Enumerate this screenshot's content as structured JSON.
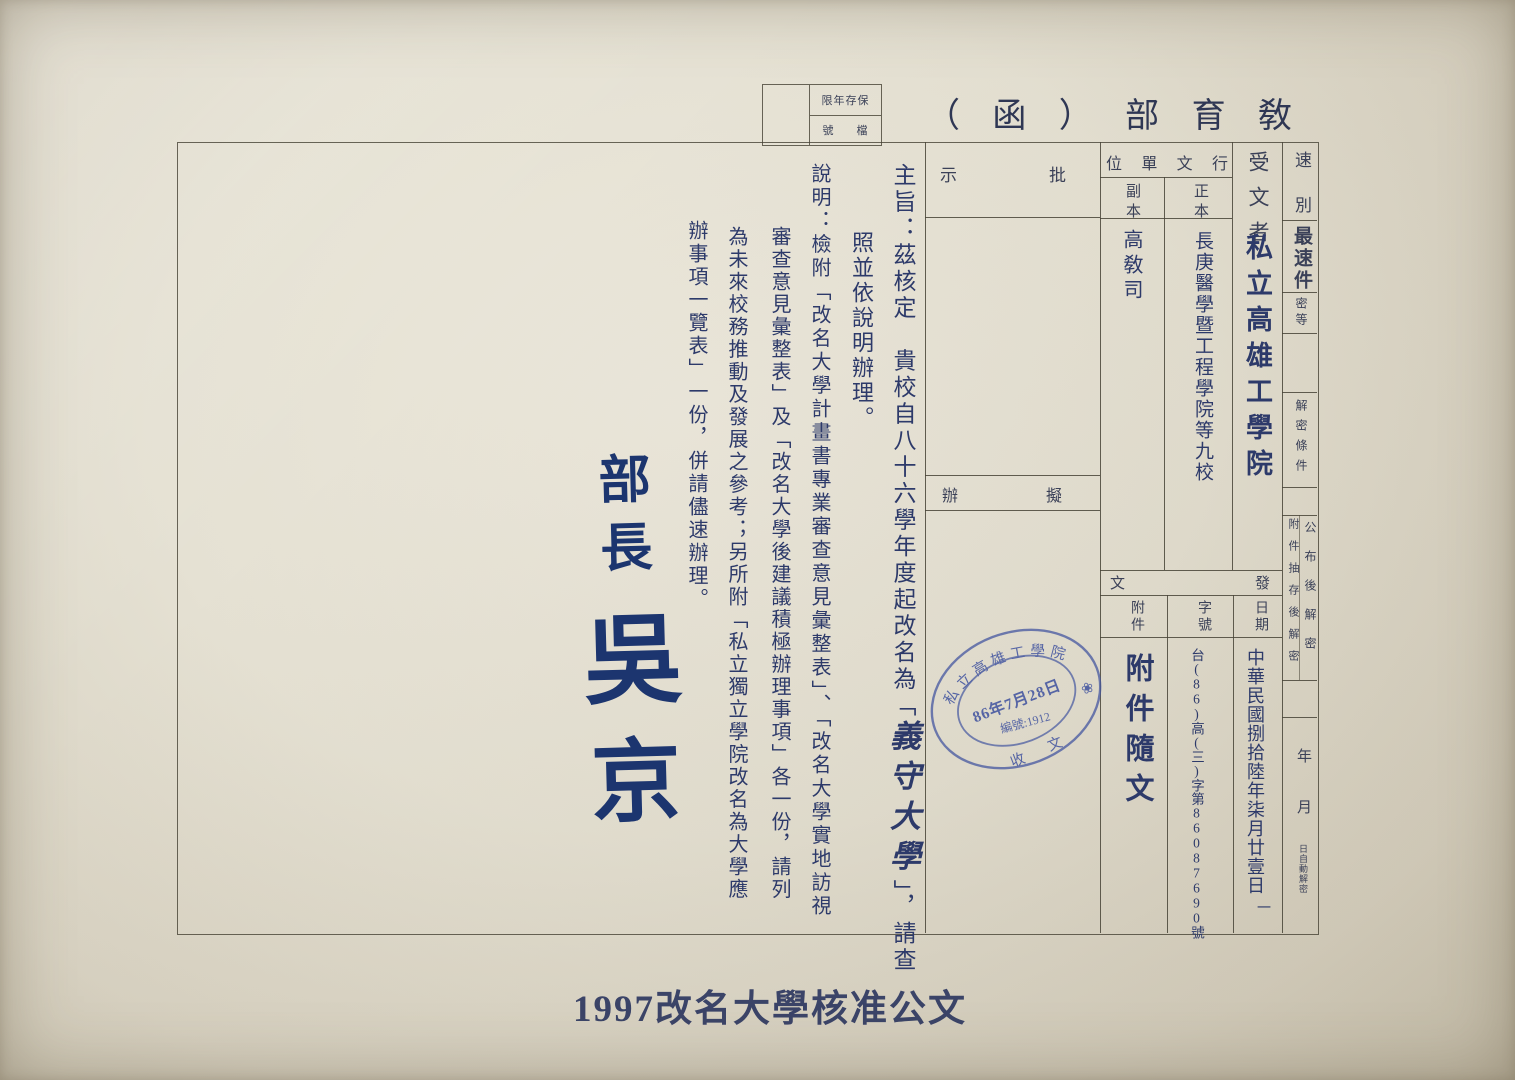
{
  "colors": {
    "paper": "#e7e3d6",
    "ink_print": "#3b4158",
    "ink_hand": "#2d3a6a",
    "ink_signature": "#1c356f",
    "stamp_ink": "#4456a0",
    "line": "#484437"
  },
  "header": {
    "title": "敎育部（函）",
    "title_chars": [
      "（",
      "函",
      "）",
      "部",
      "育",
      "敎"
    ],
    "file_box": {
      "retention_display": "限年存保",
      "retention_meaning": "保存年限",
      "file_no_left": "號",
      "file_no_right": "檔"
    }
  },
  "form": {
    "recipient_label": "受文者",
    "recipient_value": "私立高雄工學院",
    "addressee_group_chars": [
      "位",
      "單",
      "文",
      "行"
    ],
    "addressee_group_meaning": "行文單位",
    "original_label": "正本",
    "original_value": "長庚醫學暨工程學院等九校",
    "copy_label": "副本",
    "copy_value": "高敎司",
    "remarks_chars": [
      "示",
      "批"
    ],
    "remarks_meaning": "批示",
    "draft_chars": [
      "辦",
      "擬"
    ],
    "draft_meaning": "擬辦",
    "dispatch_chars": [
      "文",
      "發"
    ],
    "dispatch_meaning": "發文",
    "date_label": "日期",
    "date_value": "中華民國捌拾陸年柒月廿壹日",
    "page_mark": "一",
    "ref_label": "字號",
    "ref_value": "台(86)高(三)字第86087690號",
    "attachment_label": "附件",
    "attachment_value": "附件隨文",
    "margin": {
      "speed_label": "速別",
      "speed_value": "最速件",
      "class_label": "密等",
      "declass_label": "解密條件",
      "declass_opt1": "公布後解密",
      "declass_opt2": "附件抽存後解密",
      "auto_year": "年",
      "auto_month": "月",
      "auto_tail": "日自動解密"
    }
  },
  "body": {
    "subject_pre": "主旨：茲核定　貴校自八十六學年度起改名為「",
    "subject_school": "義守大學",
    "subject_post": "」，請查",
    "subject_cont": "照並依說明辦理。",
    "explain_col1": "說明：檢附「改名大學計畫書專業審查意見彙整表」、「改名大學實地訪視",
    "explain_col2": "審查意見彙整表」及「改名大學後建議積極辦理事項」各一份，請列",
    "explain_col3": "為未來校務推動及發展之參考；另所附「私立獨立學院改名為大學應",
    "explain_col4": "辦事項一覽表」一份，併請儘速辦理。"
  },
  "signature": {
    "title": "部長",
    "name_char1": "吳",
    "name_char2": "京"
  },
  "stamp": {
    "arc_top": "私立高雄工學院",
    "date": "86年7月28日",
    "serial": "編號:1912",
    "bottom_left": "收",
    "bottom_right": "文",
    "emblem": "❀"
  },
  "caption": "1997改名大學核准公文"
}
